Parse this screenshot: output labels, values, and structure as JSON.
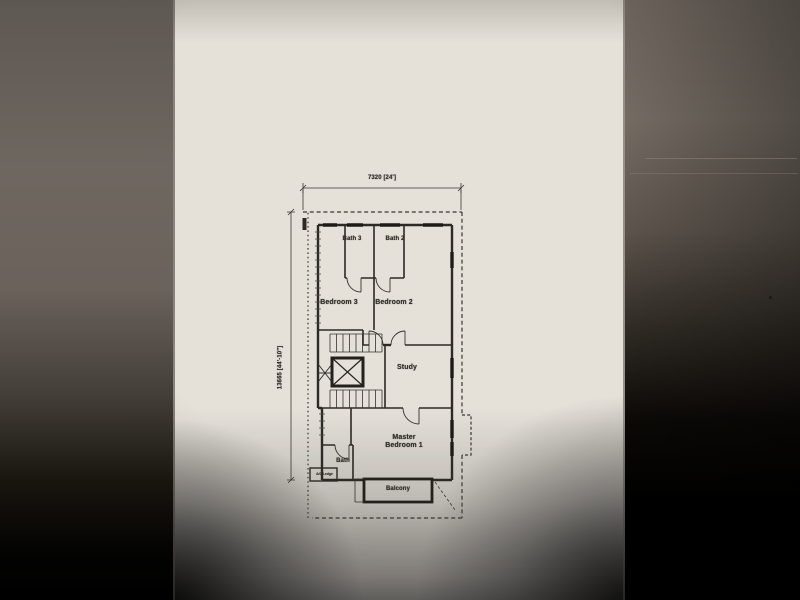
{
  "photo": {
    "description": "Photograph of an upper-storey architectural floor plan printed on white paper, lying on a dark surface",
    "paper_color": "#e5e1d9",
    "background_color": "#000000",
    "line_color": "#2c2a26"
  },
  "plan": {
    "dimension_top": "7320 [24']",
    "dimension_left": "13665 [44'-10\"]",
    "labels": {
      "bath3": "Bath 3",
      "bath2": "Bath 2",
      "bedroom3": "Bedroom 3",
      "bedroom2": "Bedroom 2",
      "study": "Study",
      "master_line1": "Master",
      "master_line2": "Bedroom 1",
      "bath": "Bath",
      "ac_ledge": "A/C Ledge",
      "balcony": "Balcony"
    },
    "symbols": [
      "staircase",
      "lift-shaft",
      "door-swings",
      "windows",
      "dashed-boundary"
    ]
  }
}
